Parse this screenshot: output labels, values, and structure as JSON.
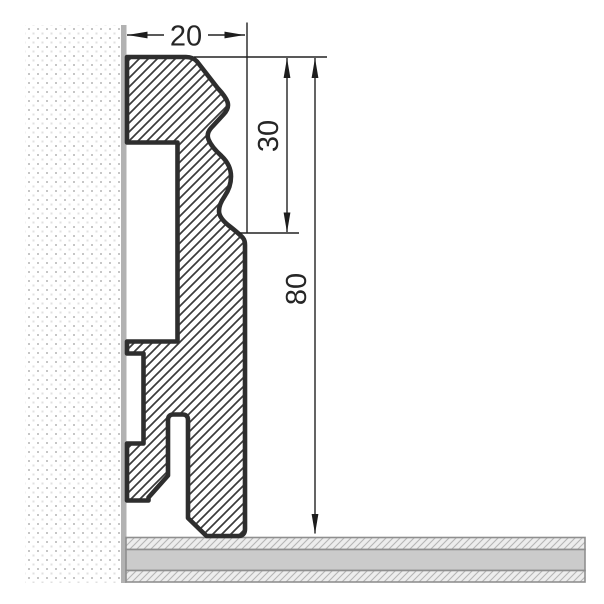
{
  "drawing": {
    "kind": "skirting-board profile cross-section",
    "dimension_labels": {
      "profile_width": "20",
      "upper_section_height": "30",
      "total_height": "80"
    },
    "icons": [
      "dimension-arrow-left-icon",
      "dimension-arrow-right-icon",
      "dimension-arrow-up-icon",
      "dimension-arrow-down-icon"
    ],
    "colors": {
      "profile_outline": "#2e2e2e",
      "profile_hatch": "#3b3b3b",
      "dimension_line": "#222222",
      "wall_surface_line": "#b2b2b2",
      "wall_dot_dark": "#c6c6c6",
      "wall_dot_light": "#e0e0e0",
      "floor_solid_gray": "#cbcbcb",
      "floor_border_gray": "#8f8f8f",
      "background": "#ffffff"
    }
  }
}
